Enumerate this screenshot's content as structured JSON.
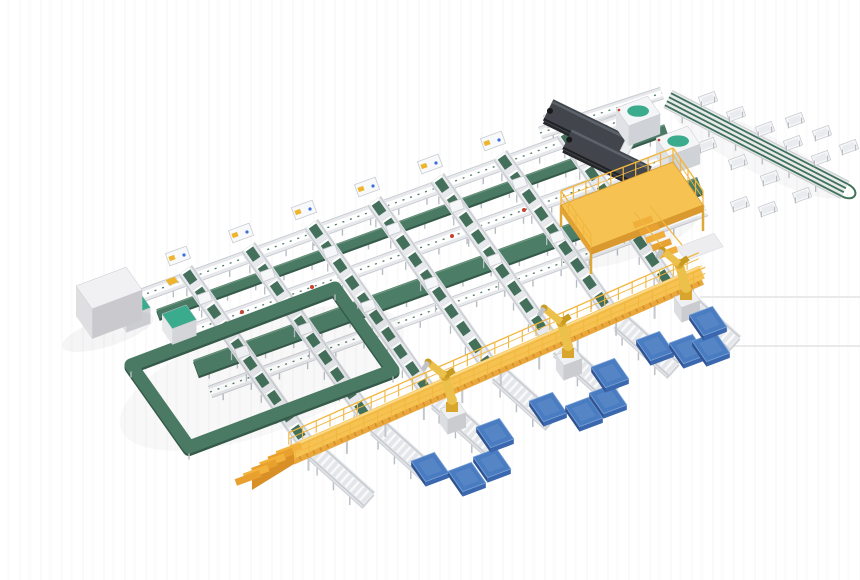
{
  "canvas": {
    "w": 860,
    "h": 580
  },
  "iso": {
    "U": [
      0.93,
      -0.35
    ],
    "V": [
      0.574,
      0.819
    ]
  },
  "palette": {
    "belt": "#4a7a64",
    "beltDark": "#355a4a",
    "beltLight": "#6d957f",
    "trunk": "#4c7d66",
    "laneGreen": "#44705b",
    "frameBase": "#e7e9ec",
    "frameEdge": "#c9ccd1",
    "frameLeg": "#b9bdc2",
    "slat": "#f8f9fa",
    "teal": "#3bab8d",
    "darkTop": "#42464c",
    "darkShadow": "#26282c",
    "darkHi": "#5c636b",
    "darkLow": "#1f2124",
    "deck": "#f6c353",
    "deckSide": "#e9a73c",
    "deckHi": "#fbdc8f",
    "rail": "#f1b73f",
    "stair": "#e8a02e",
    "stairDark": "#d88f26",
    "robo": "#ecc14b",
    "roboMid": "#d8a62c",
    "roboDark": "#c79a22",
    "palTop": "#4a7cc2",
    "palL": "#305492",
    "palR": "#3a67ad",
    "palHi": "#7ba3d8",
    "cabTop": "#f1f1f3",
    "cabL": "#dfdfe1",
    "cabR": "#cacace",
    "red": "#c8402f",
    "blue": "#3a6fd8",
    "faint": "#e4e4e4",
    "grayPanel": "#ededef"
  },
  "elements": [
    {
      "t": "shadow",
      "name": "spur-floor-shadow",
      "cx": 758,
      "cy": 152,
      "rx": 95,
      "ry": 20,
      "rot": 27,
      "o": 0.04
    },
    {
      "t": "row",
      "name": "top-link-conveyor",
      "x1": 540,
      "y1": 133,
      "x2": 662,
      "y2": 93,
      "w": 12,
      "s": "white"
    },
    {
      "t": "spur",
      "name": "packing-spur-conveyor",
      "x1": 668,
      "y1": 99,
      "x2": 845,
      "y2": 190,
      "w": 20
    },
    {
      "t": "table",
      "name": "packing-table",
      "x": 708,
      "y": 99
    },
    {
      "t": "table",
      "name": "packing-table",
      "x": 736,
      "y": 114
    },
    {
      "t": "table",
      "name": "packing-table",
      "x": 765,
      "y": 129
    },
    {
      "t": "table",
      "name": "packing-table",
      "x": 793,
      "y": 143
    },
    {
      "t": "table",
      "name": "packing-table",
      "x": 821,
      "y": 158
    },
    {
      "t": "table",
      "name": "packing-table",
      "x": 707,
      "y": 145
    },
    {
      "t": "table",
      "name": "packing-table",
      "x": 738,
      "y": 162
    },
    {
      "t": "table",
      "name": "packing-table",
      "x": 770,
      "y": 178
    },
    {
      "t": "table",
      "name": "packing-table",
      "x": 802,
      "y": 195
    },
    {
      "t": "table",
      "name": "packing-table",
      "x": 795,
      "y": 120
    },
    {
      "t": "table",
      "name": "packing-table",
      "x": 822,
      "y": 133
    },
    {
      "t": "table",
      "name": "packing-table",
      "x": 849,
      "y": 147
    },
    {
      "t": "table",
      "name": "packing-table",
      "x": 740,
      "y": 204
    },
    {
      "t": "table",
      "name": "packing-table",
      "x": 768,
      "y": 209
    },
    {
      "t": "row",
      "name": "infeed-conveyor-row",
      "x1": 132,
      "y1": 299,
      "x2": 655,
      "y2": 108,
      "w": 13,
      "s": "white"
    },
    {
      "t": "row",
      "name": "cross-belt-row",
      "x1": 158,
      "y1": 314,
      "x2": 666,
      "y2": 129,
      "w": 10,
      "s": "green"
    },
    {
      "t": "row",
      "name": "roller-conveyor-row",
      "x1": 172,
      "y1": 338,
      "x2": 678,
      "y2": 154,
      "w": 13,
      "s": "white"
    },
    {
      "t": "row",
      "name": "main-trunk-belt",
      "x1": 196,
      "y1": 368,
      "x2": 700,
      "y2": 185,
      "w": 17,
      "s": "trunk"
    },
    {
      "t": "row",
      "name": "lower-conveyor-row",
      "x1": 210,
      "y1": 392,
      "x2": 706,
      "y2": 210,
      "w": 12,
      "s": "white"
    },
    {
      "t": "dot",
      "name": "estop-marker",
      "x": 242,
      "y": 312,
      "r": 2,
      "f": "#c8402f"
    },
    {
      "t": "dot",
      "name": "estop-marker",
      "x": 312,
      "y": 287,
      "r": 2,
      "f": "#c8402f"
    },
    {
      "t": "dot",
      "name": "estop-marker",
      "x": 452,
      "y": 236,
      "r": 2,
      "f": "#c8402f"
    },
    {
      "t": "dot",
      "name": "estop-marker",
      "x": 524,
      "y": 210,
      "r": 2,
      "f": "#c8402f"
    },
    {
      "t": "flat",
      "name": "parcel",
      "x": 172,
      "y": 281,
      "w": 10,
      "d": 7,
      "f": "#edb42c"
    },
    {
      "t": "lane",
      "name": "sorter-lane",
      "x1": 185,
      "y1": 270,
      "x2": 306,
      "y2": 443
    },
    {
      "t": "lane",
      "name": "sorter-lane",
      "x1": 248,
      "y1": 247,
      "x2": 367,
      "y2": 417
    },
    {
      "t": "lane",
      "name": "sorter-lane",
      "x1": 311,
      "y1": 224,
      "x2": 428,
      "y2": 391
    },
    {
      "t": "lane",
      "name": "sorter-lane",
      "x1": 374,
      "y1": 201,
      "x2": 489,
      "y2": 365
    },
    {
      "t": "lane",
      "name": "sorter-lane",
      "x1": 437,
      "y1": 178,
      "x2": 550,
      "y2": 339
    },
    {
      "t": "lane",
      "name": "sorter-lane",
      "x1": 500,
      "y1": 155,
      "x2": 611,
      "y2": 313
    },
    {
      "t": "lane",
      "name": "sorter-lane",
      "x1": 563,
      "y1": 132,
      "x2": 672,
      "y2": 288
    },
    {
      "t": "topbox",
      "name": "lane-induct-station",
      "x": 178,
      "y": 256
    },
    {
      "t": "topbox",
      "name": "lane-induct-station",
      "x": 241,
      "y": 233
    },
    {
      "t": "topbox",
      "name": "lane-induct-station",
      "x": 304,
      "y": 210
    },
    {
      "t": "topbox",
      "name": "lane-induct-station",
      "x": 367,
      "y": 187
    },
    {
      "t": "topbox",
      "name": "lane-induct-station",
      "x": 430,
      "y": 164
    },
    {
      "t": "topbox",
      "name": "lane-induct-station",
      "x": 493,
      "y": 141
    },
    {
      "t": "topbox",
      "name": "lane-induct-station",
      "x": 556,
      "y": 118
    },
    {
      "t": "loader",
      "name": "telescopic-loader",
      "x": 585,
      "y": 128,
      "len": 82,
      "w": 24,
      "ang": 26
    },
    {
      "t": "loader",
      "name": "telescopic-loader",
      "x": 607,
      "y": 158,
      "len": 88,
      "w": 24,
      "ang": 26
    },
    {
      "t": "box3d",
      "name": "scanner-housing",
      "x": 616,
      "y": 128,
      "w": 34,
      "d": 22,
      "h": 20,
      "ct": "#f4f5f7",
      "cl": "#e0e2e5",
      "cr": "#cfd2d6",
      "teal": true
    },
    {
      "t": "box3d",
      "name": "scanner-housing",
      "x": 656,
      "y": 158,
      "w": 34,
      "d": 22,
      "h": 20,
      "ct": "#f4f5f7",
      "cl": "#e0e2e5",
      "cr": "#cfd2d6",
      "teal": true
    },
    {
      "t": "shadow",
      "name": "loop-floor-shadow",
      "cx": 262,
      "cy": 378,
      "rx": 150,
      "ry": 55,
      "rot": -20,
      "o": 0.035
    },
    {
      "t": "ring",
      "name": "loop-conveyor",
      "pts": [
        [
          335,
          288
        ],
        [
          393,
          370
        ],
        [
          189,
          447
        ],
        [
          131,
          365
        ]
      ],
      "w": 13
    },
    {
      "t": "box3d",
      "name": "loop-infeed-station",
      "x": 116,
      "y": 318,
      "w": 26,
      "d": 18,
      "h": 16,
      "ct": "#3bab8d",
      "cl": "#e6e8ea",
      "cr": "#d3d5d8",
      "teal": false
    },
    {
      "t": "box3d",
      "name": "loop-infeed-station",
      "x": 162,
      "y": 330,
      "w": 26,
      "d": 18,
      "h": 16,
      "ct": "#3bab8d",
      "cl": "#e6e8ea",
      "cr": "#d3d5d8",
      "teal": false
    },
    {
      "t": "shadow",
      "name": "cabinet-floor-shadow",
      "cx": 108,
      "cy": 332,
      "rx": 48,
      "ry": 14,
      "rot": -18,
      "o": 0.05
    },
    {
      "t": "box3d",
      "name": "control-cabinet",
      "x": 76,
      "y": 316,
      "w": 54,
      "d": 28,
      "h": 30,
      "ct": "#f1f1f3",
      "cl": "#dfdfe1",
      "cr": "#cacace",
      "teal": false
    },
    {
      "t": "shadow",
      "name": "mezzanine-floor-shadow",
      "cx": 632,
      "cy": 238,
      "rx": 70,
      "ry": 20,
      "rot": -20,
      "o": 0.04
    },
    {
      "t": "mezz",
      "name": "mezzanine-platform",
      "pts": [
        [
          673,
          162
        ],
        [
          703,
          205
        ],
        [
          591,
          248
        ],
        [
          561,
          205
        ]
      ]
    },
    {
      "t": "flat",
      "name": "staging-panel",
      "x": 700,
      "y": 247,
      "w": 40,
      "d": 16,
      "f": "#ededef"
    },
    {
      "t": "line",
      "name": "floor-line",
      "x1": 700,
      "y1": 297,
      "x2": 860,
      "y2": 297,
      "w": 1.5,
      "st": "#e4e4e4"
    },
    {
      "t": "line",
      "name": "floor-line",
      "x1": 716,
      "y1": 346,
      "x2": 860,
      "y2": 346,
      "w": 1.5,
      "st": "#e4e4e4"
    },
    {
      "t": "stub",
      "name": "discharge-conveyor",
      "x": 315,
      "y": 451,
      "ang": 42,
      "len": 72,
      "w": 20
    },
    {
      "t": "stub",
      "name": "discharge-conveyor",
      "x": 376,
      "y": 425,
      "ang": 42,
      "len": 72,
      "w": 20
    },
    {
      "t": "stub",
      "name": "discharge-conveyor",
      "x": 437,
      "y": 399,
      "ang": 42,
      "len": 72,
      "w": 20
    },
    {
      "t": "stub",
      "name": "discharge-conveyor",
      "x": 498,
      "y": 373,
      "ang": 42,
      "len": 72,
      "w": 20
    },
    {
      "t": "stub",
      "name": "discharge-conveyor",
      "x": 559,
      "y": 347,
      "ang": 42,
      "len": 72,
      "w": 20
    },
    {
      "t": "stub",
      "name": "discharge-conveyor",
      "x": 620,
      "y": 321,
      "ang": 42,
      "len": 72,
      "w": 20
    },
    {
      "t": "stub",
      "name": "discharge-conveyor",
      "x": 681,
      "y": 295,
      "ang": 42,
      "len": 72,
      "w": 20
    },
    {
      "t": "walkway",
      "name": "operator-walkway",
      "x1": 292,
      "y1": 452,
      "x2": 702,
      "y2": 272,
      "w": 19
    },
    {
      "t": "wstairs",
      "name": "walkway-stairs",
      "x": 296,
      "y": 448
    },
    {
      "t": "robot",
      "name": "palletizing-robot",
      "x": 452,
      "y": 426
    },
    {
      "t": "robot",
      "name": "palletizing-robot",
      "x": 568,
      "y": 372
    },
    {
      "t": "robot",
      "name": "palletizing-robot",
      "x": 686,
      "y": 314
    },
    {
      "t": "pallet",
      "name": "pallet",
      "x": 430,
      "y": 467,
      "s": 25
    },
    {
      "t": "pallet",
      "name": "pallet",
      "x": 467,
      "y": 477,
      "s": 25
    },
    {
      "t": "pallet",
      "name": "pallet",
      "x": 492,
      "y": 463,
      "s": 25
    },
    {
      "t": "pallet",
      "name": "pallet",
      "x": 495,
      "y": 433,
      "s": 25
    },
    {
      "t": "pallet",
      "name": "pallet",
      "x": 548,
      "y": 407,
      "s": 25
    },
    {
      "t": "pallet",
      "name": "pallet",
      "x": 584,
      "y": 412,
      "s": 25
    },
    {
      "t": "pallet",
      "name": "pallet",
      "x": 608,
      "y": 399,
      "s": 25
    },
    {
      "t": "pallet",
      "name": "pallet",
      "x": 610,
      "y": 373,
      "s": 25
    },
    {
      "t": "pallet",
      "name": "pallet",
      "x": 655,
      "y": 346,
      "s": 25
    },
    {
      "t": "pallet",
      "name": "pallet",
      "x": 688,
      "y": 349,
      "s": 25
    },
    {
      "t": "pallet",
      "name": "pallet",
      "x": 711,
      "y": 347,
      "s": 25
    },
    {
      "t": "pallet",
      "name": "pallet",
      "x": 708,
      "y": 321,
      "s": 25
    }
  ]
}
